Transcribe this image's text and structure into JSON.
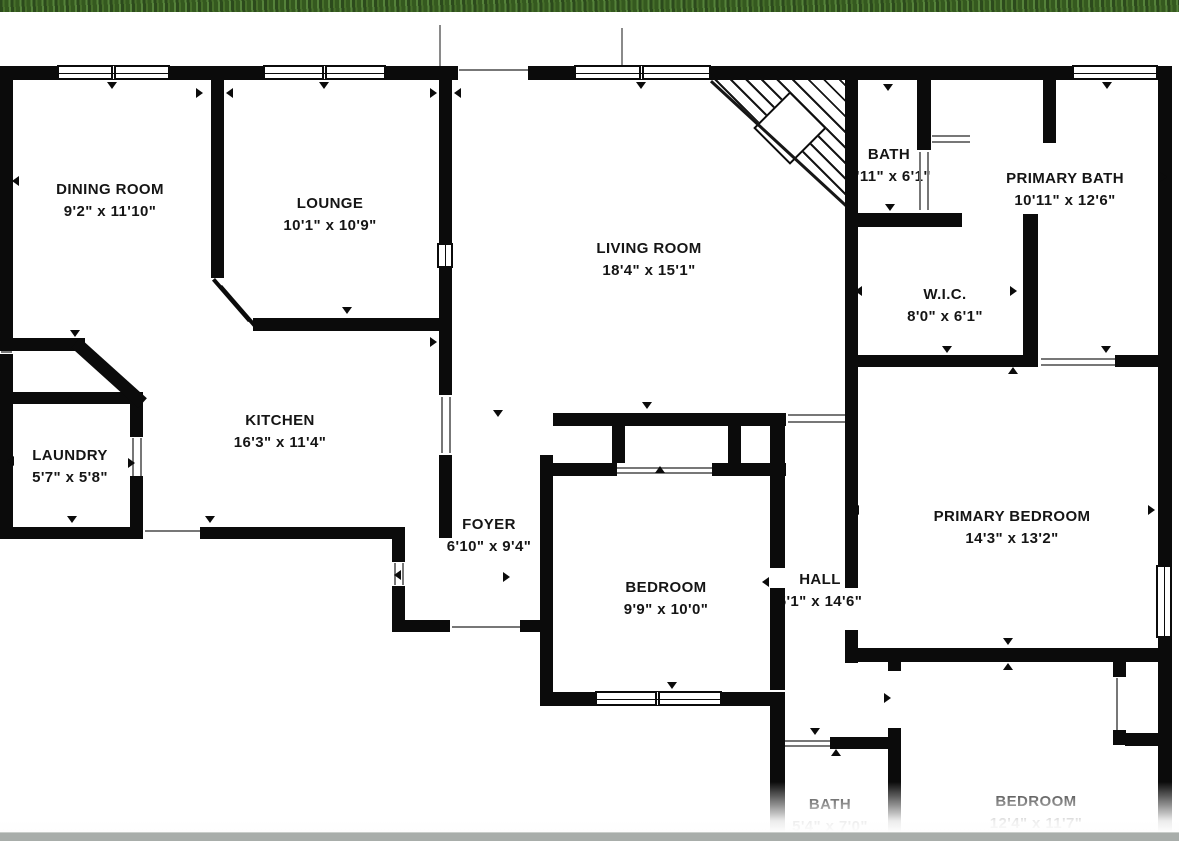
{
  "document": {
    "type": "residential floor plan",
    "wall_color": "#0b0b0b",
    "background_color": "#ffffff",
    "top_edge": "grass photo strip",
    "bottom_edge": "grey page bar"
  },
  "floor_plan": {
    "rooms": [
      {
        "id": "dining-room",
        "name": "DINING ROOM",
        "dims": "9'2\" x 11'10\""
      },
      {
        "id": "lounge",
        "name": "LOUNGE",
        "dims": "10'1\" x 10'9\""
      },
      {
        "id": "living-room",
        "name": "LIVING ROOM",
        "dims": "18'4\" x 15'1\""
      },
      {
        "id": "bath-top",
        "name": "BATH",
        "dims": "5'11\" x 6'1\""
      },
      {
        "id": "primary-bath",
        "name": "PRIMARY BATH",
        "dims": "10'11\" x 12'6\""
      },
      {
        "id": "wic",
        "name": "W.I.C.",
        "dims": "8'0\" x 6'1\""
      },
      {
        "id": "kitchen",
        "name": "KITCHEN",
        "dims": "16'3\" x 11'4\""
      },
      {
        "id": "laundry",
        "name": "LAUNDRY",
        "dims": "5'7\" x 5'8\""
      },
      {
        "id": "foyer",
        "name": "FOYER",
        "dims": "6'10\" x 9'4\""
      },
      {
        "id": "bedroom",
        "name": "BEDROOM",
        "dims": "9'9\" x 10'0\""
      },
      {
        "id": "hall",
        "name": "HALL",
        "dims": "5'1\" x 14'6\""
      },
      {
        "id": "primary-bedroom",
        "name": "PRIMARY BEDROOM",
        "dims": "14'3\" x 13'2\""
      },
      {
        "id": "bath-bottom",
        "name": "BATH",
        "dims": "5'4\" x 7'0\""
      },
      {
        "id": "bedroom-bottom",
        "name": "BEDROOM",
        "dims": "12'4\" x 11'7\""
      }
    ],
    "features": {
      "staircase": "winder staircase with diagonal treads and square landing, top-right of living room",
      "window_icon": "double-line window glyph",
      "door_icon": "small black triangle swing marker"
    }
  }
}
